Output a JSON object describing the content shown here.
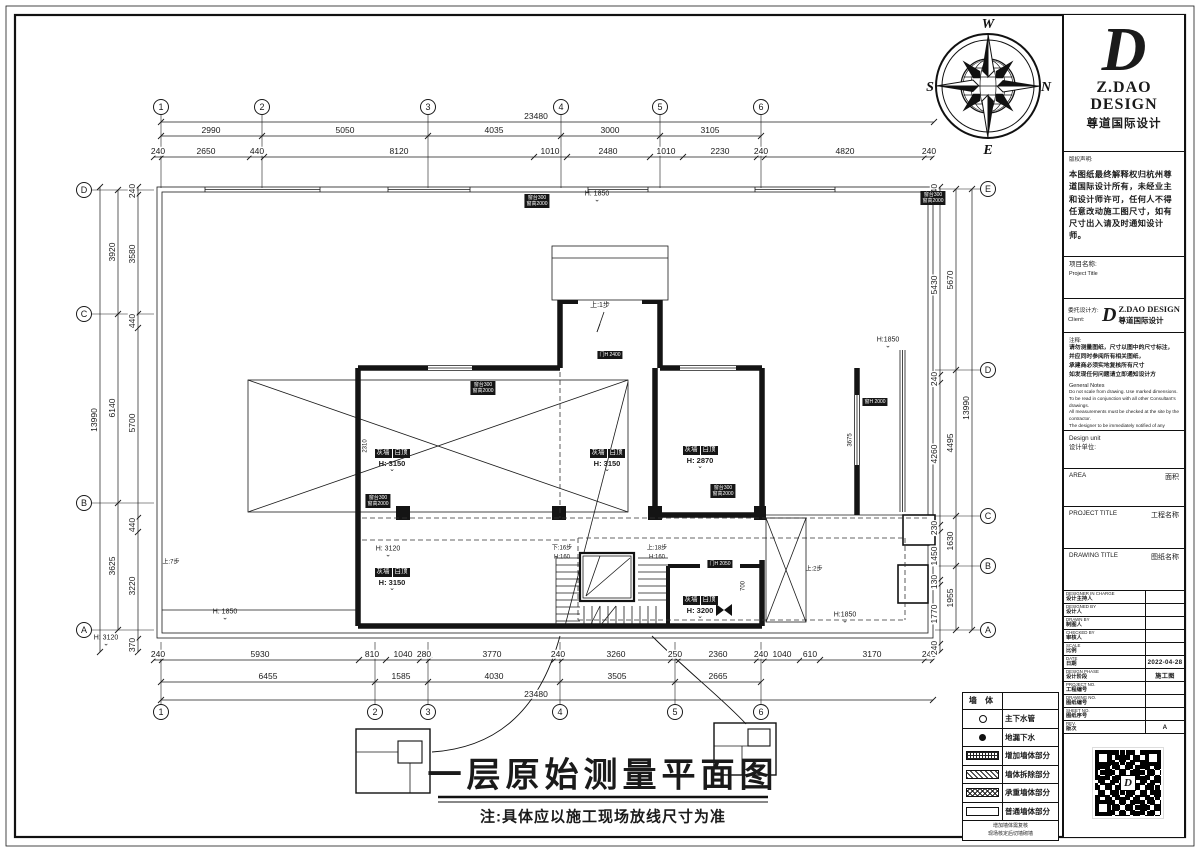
{
  "sheet": {
    "title": "一层原始测量平面图",
    "title_note": "注:具体应以施工现场放线尺寸为准"
  },
  "compass": {
    "top": "W",
    "left": "S",
    "bottom": "E",
    "right": "N"
  },
  "colors": {
    "line": "#1a1a1a",
    "paper": "#ffffff",
    "tag_bg": "#161616"
  },
  "bubbles": [
    {
      "t": "1",
      "x": 161,
      "y": 107
    },
    {
      "t": "2",
      "x": 262,
      "y": 107
    },
    {
      "t": "3",
      "x": 428,
      "y": 107
    },
    {
      "t": "4",
      "x": 561,
      "y": 107
    },
    {
      "t": "5",
      "x": 660,
      "y": 107
    },
    {
      "t": "6",
      "x": 761,
      "y": 107
    },
    {
      "t": "1",
      "x": 161,
      "y": 712
    },
    {
      "t": "2",
      "x": 375,
      "y": 712
    },
    {
      "t": "3",
      "x": 428,
      "y": 712
    },
    {
      "t": "4",
      "x": 560,
      "y": 712
    },
    {
      "t": "5",
      "x": 675,
      "y": 712
    },
    {
      "t": "6",
      "x": 761,
      "y": 712
    },
    {
      "t": "D",
      "x": 84,
      "y": 190
    },
    {
      "t": "C",
      "x": 84,
      "y": 314
    },
    {
      "t": "B",
      "x": 84,
      "y": 503
    },
    {
      "t": "A",
      "x": 84,
      "y": 630
    },
    {
      "t": "E",
      "x": 988,
      "y": 189
    },
    {
      "t": "D",
      "x": 988,
      "y": 370
    },
    {
      "t": "C",
      "x": 988,
      "y": 516
    },
    {
      "t": "B",
      "x": 988,
      "y": 566
    },
    {
      "t": "A",
      "x": 988,
      "y": 630
    }
  ],
  "dim_rows": [
    {
      "o": "h",
      "y": 122,
      "a": 161,
      "b": 934,
      "ticks": [
        161,
        934
      ],
      "labels": [
        {
          "t": "23480",
          "x": 536
        }
      ]
    },
    {
      "o": "h",
      "y": 136,
      "a": 161,
      "b": 761,
      "ticks": [
        161,
        262,
        428,
        561,
        660,
        761
      ],
      "labels": [
        {
          "t": "2990",
          "x": 211
        },
        {
          "t": "5050",
          "x": 345
        },
        {
          "t": "4035",
          "x": 494
        },
        {
          "t": "3000",
          "x": 610
        },
        {
          "t": "3105",
          "x": 710
        }
      ]
    },
    {
      "o": "h",
      "y": 157,
      "a": 154,
      "b": 933,
      "ticks": [
        154,
        162,
        250,
        264,
        534,
        567,
        650,
        683,
        757,
        765,
        925,
        933
      ],
      "labels": [
        {
          "t": "240",
          "x": 158
        },
        {
          "t": "2650",
          "x": 206
        },
        {
          "t": "440",
          "x": 257
        },
        {
          "t": "8120",
          "x": 399
        },
        {
          "t": "1010",
          "x": 550
        },
        {
          "t": "2480",
          "x": 608
        },
        {
          "t": "1010",
          "x": 666
        },
        {
          "t": "2230",
          "x": 720
        },
        {
          "t": "240",
          "x": 761
        },
        {
          "t": "4820",
          "x": 845
        },
        {
          "t": "240",
          "x": 929
        }
      ]
    },
    {
      "o": "h",
      "y": 660,
      "a": 154,
      "b": 933,
      "ticks": [
        154,
        162,
        359,
        386,
        420,
        429,
        554,
        562,
        671,
        679,
        757,
        765,
        800,
        820,
        925,
        933
      ],
      "labels": [
        {
          "t": "240",
          "x": 158
        },
        {
          "t": "5930",
          "x": 260
        },
        {
          "t": "810",
          "x": 372
        },
        {
          "t": "1040",
          "x": 403
        },
        {
          "t": "280",
          "x": 424
        },
        {
          "t": "3770",
          "x": 492
        },
        {
          "t": "240",
          "x": 558
        },
        {
          "t": "3260",
          "x": 616
        },
        {
          "t": "250",
          "x": 675
        },
        {
          "t": "2360",
          "x": 718
        },
        {
          "t": "240",
          "x": 761
        },
        {
          "t": "1040",
          "x": 782
        },
        {
          "t": "610",
          "x": 810
        },
        {
          "t": "3170",
          "x": 872
        },
        {
          "t": "240",
          "x": 929
        }
      ]
    },
    {
      "o": "h",
      "y": 682,
      "a": 161,
      "b": 761,
      "ticks": [
        161,
        375,
        428,
        560,
        675,
        761
      ],
      "labels": [
        {
          "t": "6455",
          "x": 268
        },
        {
          "t": "1585",
          "x": 401
        },
        {
          "t": "4030",
          "x": 494
        },
        {
          "t": "3505",
          "x": 617
        },
        {
          "t": "2665",
          "x": 718
        }
      ]
    },
    {
      "o": "h",
      "y": 700,
      "a": 161,
      "b": 933,
      "ticks": [
        161,
        933
      ],
      "labels": [
        {
          "t": "23480",
          "x": 536
        }
      ]
    },
    {
      "o": "v",
      "x": 100,
      "a": 187,
      "b": 652,
      "ticks": [
        187,
        652
      ],
      "labels": [
        {
          "t": "13990",
          "y": 420
        }
      ]
    },
    {
      "o": "v",
      "x": 118,
      "a": 190,
      "b": 630,
      "ticks": [
        190,
        314,
        503,
        630
      ],
      "labels": [
        {
          "t": "3920",
          "y": 252
        },
        {
          "t": "6140",
          "y": 408
        },
        {
          "t": "3625",
          "y": 566
        }
      ]
    },
    {
      "o": "v",
      "x": 138,
      "a": 187,
      "b": 652,
      "ticks": [
        187,
        195,
        314,
        328,
        518,
        532,
        639,
        652
      ],
      "labels": [
        {
          "t": "240",
          "y": 191
        },
        {
          "t": "3580",
          "y": 254
        },
        {
          "t": "440",
          "y": 321
        },
        {
          "t": "5700",
          "y": 423
        },
        {
          "t": "440",
          "y": 525
        },
        {
          "t": "3220",
          "y": 586
        },
        {
          "t": "370",
          "y": 645
        }
      ]
    },
    {
      "o": "v",
      "x": 972,
      "a": 189,
      "b": 630,
      "ticks": [
        189,
        630
      ],
      "labels": [
        {
          "t": "13990",
          "y": 408
        }
      ]
    },
    {
      "o": "v",
      "x": 956,
      "a": 189,
      "b": 630,
      "ticks": [
        189,
        370,
        516,
        566,
        630
      ],
      "labels": [
        {
          "t": "5670",
          "y": 280
        },
        {
          "t": "4495",
          "y": 443
        },
        {
          "t": "1630",
          "y": 541
        },
        {
          "t": "1955",
          "y": 598
        }
      ]
    },
    {
      "o": "v",
      "x": 940,
      "a": 187,
      "b": 652,
      "ticks": [
        187,
        195,
        375,
        383,
        525,
        532,
        580,
        585,
        644,
        652
      ],
      "labels": [
        {
          "t": "240",
          "y": 191
        },
        {
          "t": "5430",
          "y": 285
        },
        {
          "t": "240",
          "y": 379
        },
        {
          "t": "4260",
          "y": 454
        },
        {
          "t": "230",
          "y": 528
        },
        {
          "t": "1450",
          "y": 556
        },
        {
          "t": "130",
          "y": 582
        },
        {
          "t": "1770",
          "y": 614
        },
        {
          "t": "240",
          "y": 648
        }
      ]
    }
  ],
  "rooms": [
    {
      "l1": "灰墙",
      "l2": "白顶",
      "h": "H: 3150",
      "x": 392,
      "y": 441
    },
    {
      "l1": "灰墙",
      "l2": "白顶",
      "h": "H: 3150",
      "x": 607,
      "y": 441
    },
    {
      "l1": "灰墙",
      "l2": "白顶",
      "h": "H: 2870",
      "x": 700,
      "y": 438
    },
    {
      "l1": "灰墙",
      "l2": "白顶",
      "h": "H: 3150",
      "x": 392,
      "y": 560
    },
    {
      "l1": "灰墙",
      "l2": "白顶",
      "h": "H: 3200",
      "x": 700,
      "y": 588
    }
  ],
  "plan_texts": [
    {
      "t": "上:1步",
      "x": 600,
      "y": 306,
      "s": 7
    },
    {
      "t": "下:16步",
      "x": 562,
      "y": 549,
      "s": 6
    },
    {
      "t": "H:160",
      "x": 562,
      "y": 558,
      "s": 6
    },
    {
      "t": "上:18步",
      "x": 657,
      "y": 549,
      "s": 6
    },
    {
      "t": "H:160",
      "x": 657,
      "y": 558,
      "s": 6
    },
    {
      "t": "上:2步",
      "x": 814,
      "y": 570,
      "s": 6
    },
    {
      "t": "上:7步",
      "x": 171,
      "y": 563,
      "s": 6
    },
    {
      "t": "H: 3120",
      "x": 388,
      "y": 551,
      "s": 7,
      "lvl": true
    },
    {
      "t": "H: 3120",
      "x": 106,
      "y": 640,
      "s": 7,
      "lvl": true
    },
    {
      "t": "H: 1850",
      "x": 225,
      "y": 614,
      "s": 7,
      "lvl": true
    },
    {
      "t": "H:1850",
      "x": 845,
      "y": 617,
      "s": 7,
      "lvl": true
    },
    {
      "t": "H:1850",
      "x": 888,
      "y": 342,
      "s": 7,
      "lvl": true
    },
    {
      "t": "H: 1850",
      "x": 597,
      "y": 196,
      "s": 7,
      "lvl": true
    },
    {
      "t": "700",
      "x": 744,
      "y": 586,
      "s": 6,
      "rot": true
    },
    {
      "t": "2310",
      "x": 366,
      "y": 446,
      "s": 6,
      "rot": true
    },
    {
      "t": "3675",
      "x": 851,
      "y": 440,
      "s": 6,
      "rot": true
    }
  ],
  "wall_tags": [
    {
      "x": 537,
      "y": 194,
      "lines": [
        "窗台300",
        "窗高2000"
      ]
    },
    {
      "x": 933,
      "y": 191,
      "lines": [
        "窗台300",
        "窗高2000"
      ]
    },
    {
      "x": 483,
      "y": 381,
      "lines": [
        "窗台300",
        "窗高2000"
      ]
    },
    {
      "x": 378,
      "y": 494,
      "lines": [
        "窗台300",
        "窗高2000"
      ]
    },
    {
      "x": 723,
      "y": 484,
      "lines": [
        "窗台300",
        "窗高2000"
      ]
    },
    {
      "x": 875,
      "y": 398,
      "lines": [
        "窗H 2000"
      ]
    },
    {
      "x": 610,
      "y": 351,
      "lines": [
        "门H 2400"
      ]
    },
    {
      "x": 720,
      "y": 560,
      "lines": [
        "门H 2050"
      ]
    }
  ],
  "legend": {
    "header": "墙 体",
    "rows": [
      {
        "sym": "circle",
        "label": "主下水管"
      },
      {
        "sym": "dot",
        "label": "地漏下水"
      },
      {
        "sym": "hatch-dense",
        "label": "增加墙体部分"
      },
      {
        "sym": "hatch-diag",
        "label": "墙体拆除部分"
      },
      {
        "sym": "hatch-cross",
        "label": "承重墙体部分"
      },
      {
        "sym": "double",
        "label": "普通墙体部分"
      }
    ],
    "foot1": "增加墙体需复核",
    "foot2": "现场核定后切墙砌墙"
  },
  "title_block": {
    "logo": {
      "mark": "D",
      "name1": "Z.DAO",
      "name2": "DESIGN",
      "cn": "尊道国际设计"
    },
    "copyright": {
      "label": "版权声明:",
      "text": "本图纸最终解释权归杭州尊道国际设计所有，未经业主和设计师许可，任何人不得任意改动施工图尺寸，如有尺寸出入请及时通知设计师。"
    },
    "project": {
      "cn": "项目名称:",
      "en": "Project Title"
    },
    "client": {
      "cn": "委托设计方:",
      "en": "Client:",
      "logo_mark": "D",
      "logo_name": "Z.DAO DESIGN",
      "logo_cn": "尊道国际设计"
    },
    "notes_cn": {
      "label": "注释:",
      "lines": [
        "请勿测量图纸，尺寸以图中的尺寸标注，",
        "并应同时参阅所有相关图纸，",
        "承建商必须实地复核所有尺寸",
        "如发现任何问题请立即通知设计方"
      ]
    },
    "notes_en": {
      "label": "General Notes",
      "lines": [
        "Do not scale from drawing. Use marked dimensions.",
        "To be read in conjunction with all other Consultant's drawings.",
        "All measurements must be checked at the site by the contractor.",
        "The designer to be immediately notified of any discrepancies."
      ]
    },
    "design_unit": {
      "en": "Design unit",
      "cn": "设计单位:"
    },
    "area": {
      "en": "AREA",
      "cn": "面积"
    },
    "project_title": {
      "en": "PROJECT TITLE",
      "cn": "工程名称"
    },
    "drawing_title": {
      "en": "DRAWING TITLE",
      "cn": "图纸名称"
    },
    "rows": [
      {
        "en": "DESIGNER IN CHARGE",
        "cn": "设计主持人",
        "val": ""
      },
      {
        "en": "DESIGNED BY",
        "cn": "设计人",
        "val": ""
      },
      {
        "en": "DRAWN BY",
        "cn": "制图人",
        "val": ""
      },
      {
        "en": "CHECKED BY",
        "cn": "审核人",
        "val": ""
      },
      {
        "en": "SCALE",
        "cn": "比例",
        "val": ""
      },
      {
        "en": "DATE",
        "cn": "日期",
        "val": "2022-04-28"
      },
      {
        "en": "DESIGN PHASE",
        "cn": "设计阶段",
        "val": "施工图"
      },
      {
        "en": "PROJECT NO.",
        "cn": "工程编号",
        "val": ""
      },
      {
        "en": "DRAWING NO.",
        "cn": "图纸编号",
        "val": ""
      },
      {
        "en": "SHEET NO.",
        "cn": "图纸序号",
        "val": ""
      },
      {
        "en": "REV.",
        "cn": "版次",
        "val": "A"
      }
    ]
  }
}
